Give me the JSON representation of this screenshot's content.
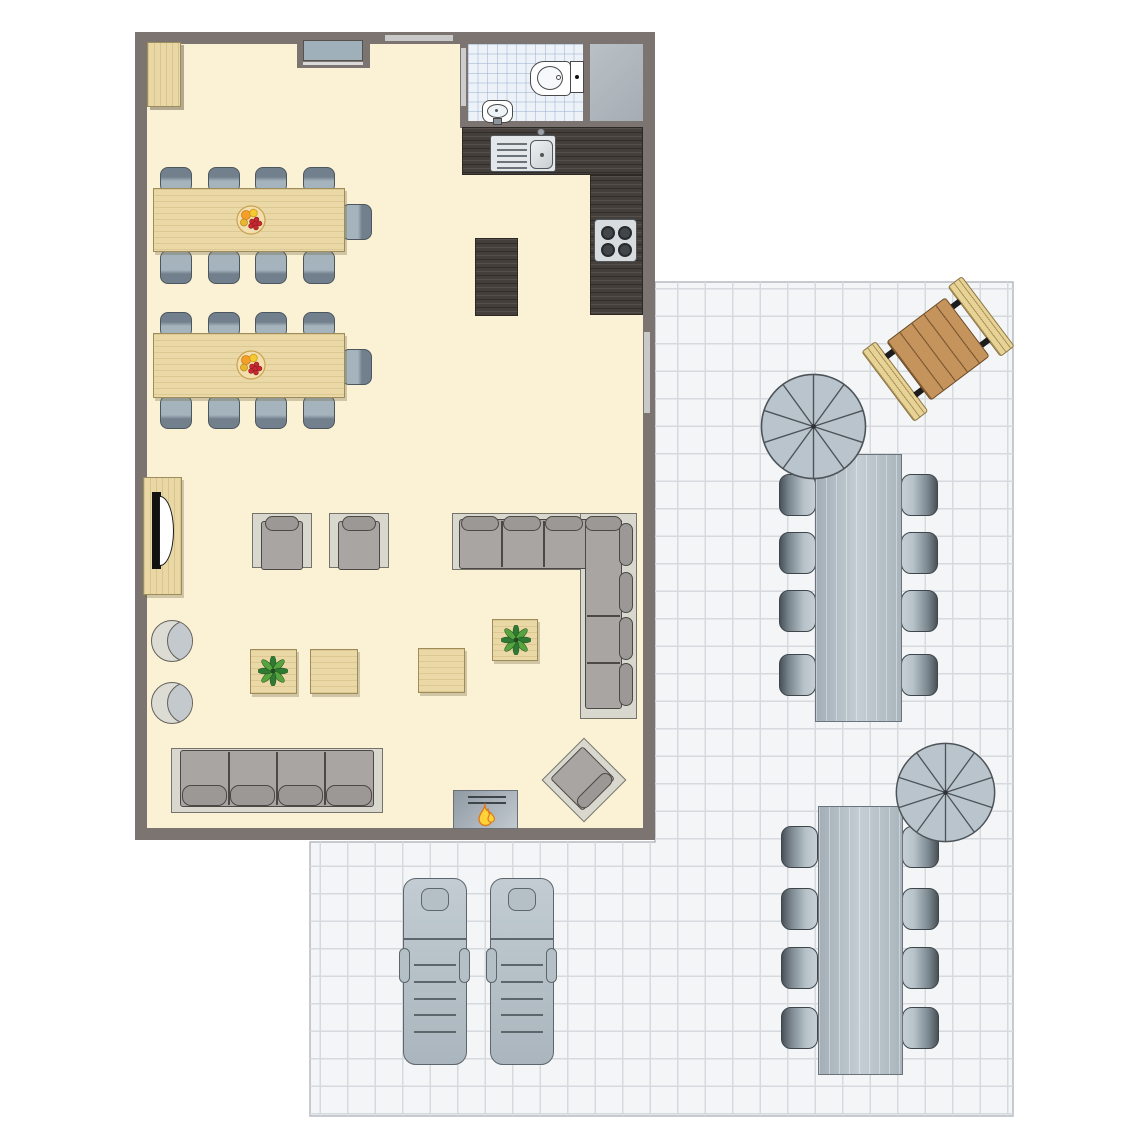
{
  "labels": {
    "floor_plan": "holiday home floor plan with patio",
    "indoor_area": "open-plan living and dining room",
    "patio": "tiled outdoor patio",
    "dining_set_1": "dining table with 9 chairs and fruit bowl",
    "dining_set_2": "dining table with 9 chairs and fruit bowl",
    "fruit_bowl": "fruit bowl",
    "wardrobe": "corner cabinet",
    "wall_niche": "window niche with sill",
    "window": "window",
    "bathroom": "bathroom with toilet and washbasin",
    "toilet": "toilet",
    "washbasin": "washbasin",
    "shower": "shower",
    "bathroom_door": "bathroom door",
    "kitchen_counter": "kitchen counter with sink",
    "kitchen_sink": "kitchen sink with drainer",
    "stove": "four-burner stove",
    "kitchen_island": "kitchen island",
    "tv_cabinet": "TV cabinet with television",
    "armchair": "armchair",
    "corner_sofa": "corner sofa",
    "sofa": "four-seat sofa",
    "fireplace": "fireplace",
    "coffee_table": "coffee table",
    "plant_table": "coffee table with plant",
    "plant": "potted plant",
    "pouf": "round pouf",
    "diagonal_armchair": "armchair rotated 45 degrees",
    "picnic_table": "wooden picnic table with two benches",
    "outdoor_dining_set_1": "outdoor dining table with 8 chairs",
    "outdoor_dining_set_2": "outdoor dining table with 8 chairs",
    "parasol": "parasol",
    "sun_lounger": "sun lounger"
  },
  "inventory": {
    "indoor": [
      {
        "item": "dining table",
        "count": 2,
        "seats_each": 9
      },
      {
        "item": "fruit bowl",
        "count": 2
      },
      {
        "item": "corner cabinet",
        "count": 1
      },
      {
        "item": "window niche",
        "count": 1
      },
      {
        "item": "toilet",
        "count": 1
      },
      {
        "item": "washbasin",
        "count": 1
      },
      {
        "item": "shower",
        "count": 1
      },
      {
        "item": "kitchen counter with sink",
        "count": 1
      },
      {
        "item": "four-burner stove",
        "count": 1
      },
      {
        "item": "kitchen island",
        "count": 1
      },
      {
        "item": "TV cabinet",
        "count": 1
      },
      {
        "item": "armchair",
        "count": 2
      },
      {
        "item": "corner sofa",
        "count": 1
      },
      {
        "item": "four-seat sofa",
        "count": 1
      },
      {
        "item": "diagonal armchair",
        "count": 1
      },
      {
        "item": "fireplace",
        "count": 1
      },
      {
        "item": "coffee table",
        "count": 2
      },
      {
        "item": "coffee table with plant",
        "count": 2
      },
      {
        "item": "round pouf",
        "count": 2
      }
    ],
    "outdoor": [
      {
        "item": "picnic table with benches",
        "count": 1
      },
      {
        "item": "outdoor dining table",
        "count": 2,
        "seats_each": 8
      },
      {
        "item": "parasol",
        "count": 2
      },
      {
        "item": "sun lounger",
        "count": 2
      }
    ]
  },
  "palette": {
    "wall": "#7b7470",
    "indoor_floor": "#fbf2d5",
    "light_wood": "#ead9a6",
    "dark_counter_wood": "#453f3b",
    "upholstery": "#a9a5a3",
    "sofa_base": "#d9d8ce",
    "chair_gray_blue": "#a5b3bd",
    "outdoor_gray": "#b7c2c9",
    "patio_floor": "#f3f5f7",
    "patio_grid_line": "#d6dade",
    "bathroom_tile": "#edf2f8",
    "picnic_top": "#c5935c",
    "picnic_bench": "#e7d396",
    "flame_yellow": "#ffd23a",
    "flame_outline": "#dd7b1c",
    "plant_green": "#2f7a33"
  }
}
